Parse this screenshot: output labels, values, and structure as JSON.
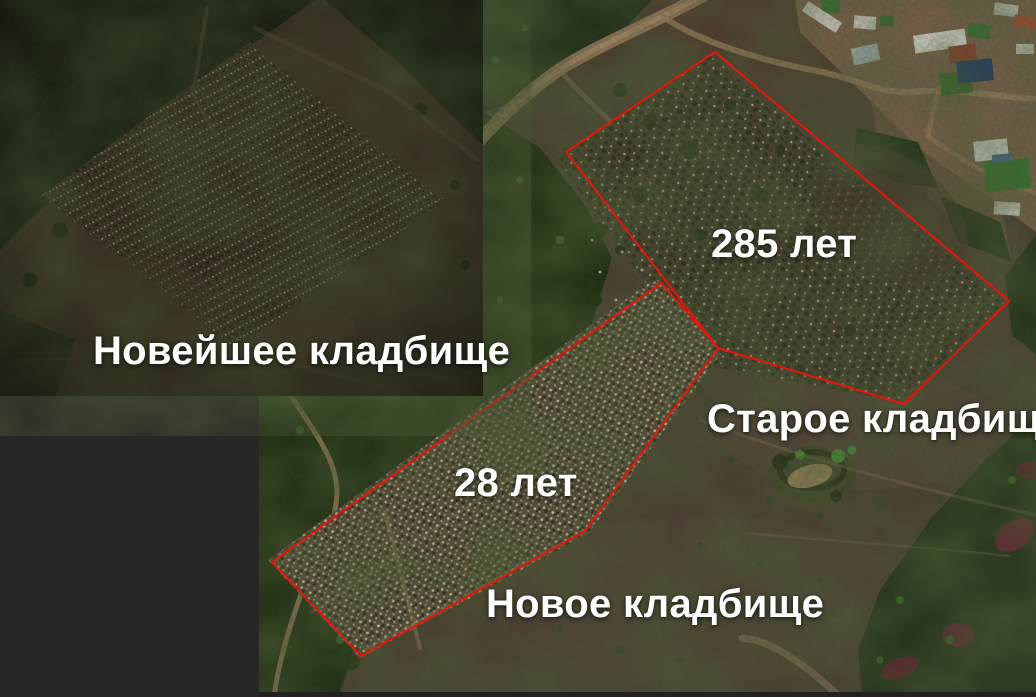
{
  "regions": {
    "newest": {
      "label": "Новейшее кладбище"
    },
    "old": {
      "label": "Старое кладбище",
      "age": "285 лет"
    },
    "new": {
      "label": "Новое кладбище",
      "age": "28 лет"
    }
  },
  "colors": {
    "outline_red": "#e8150a",
    "label_white": "#ffffff",
    "mask_black": "#272727"
  }
}
